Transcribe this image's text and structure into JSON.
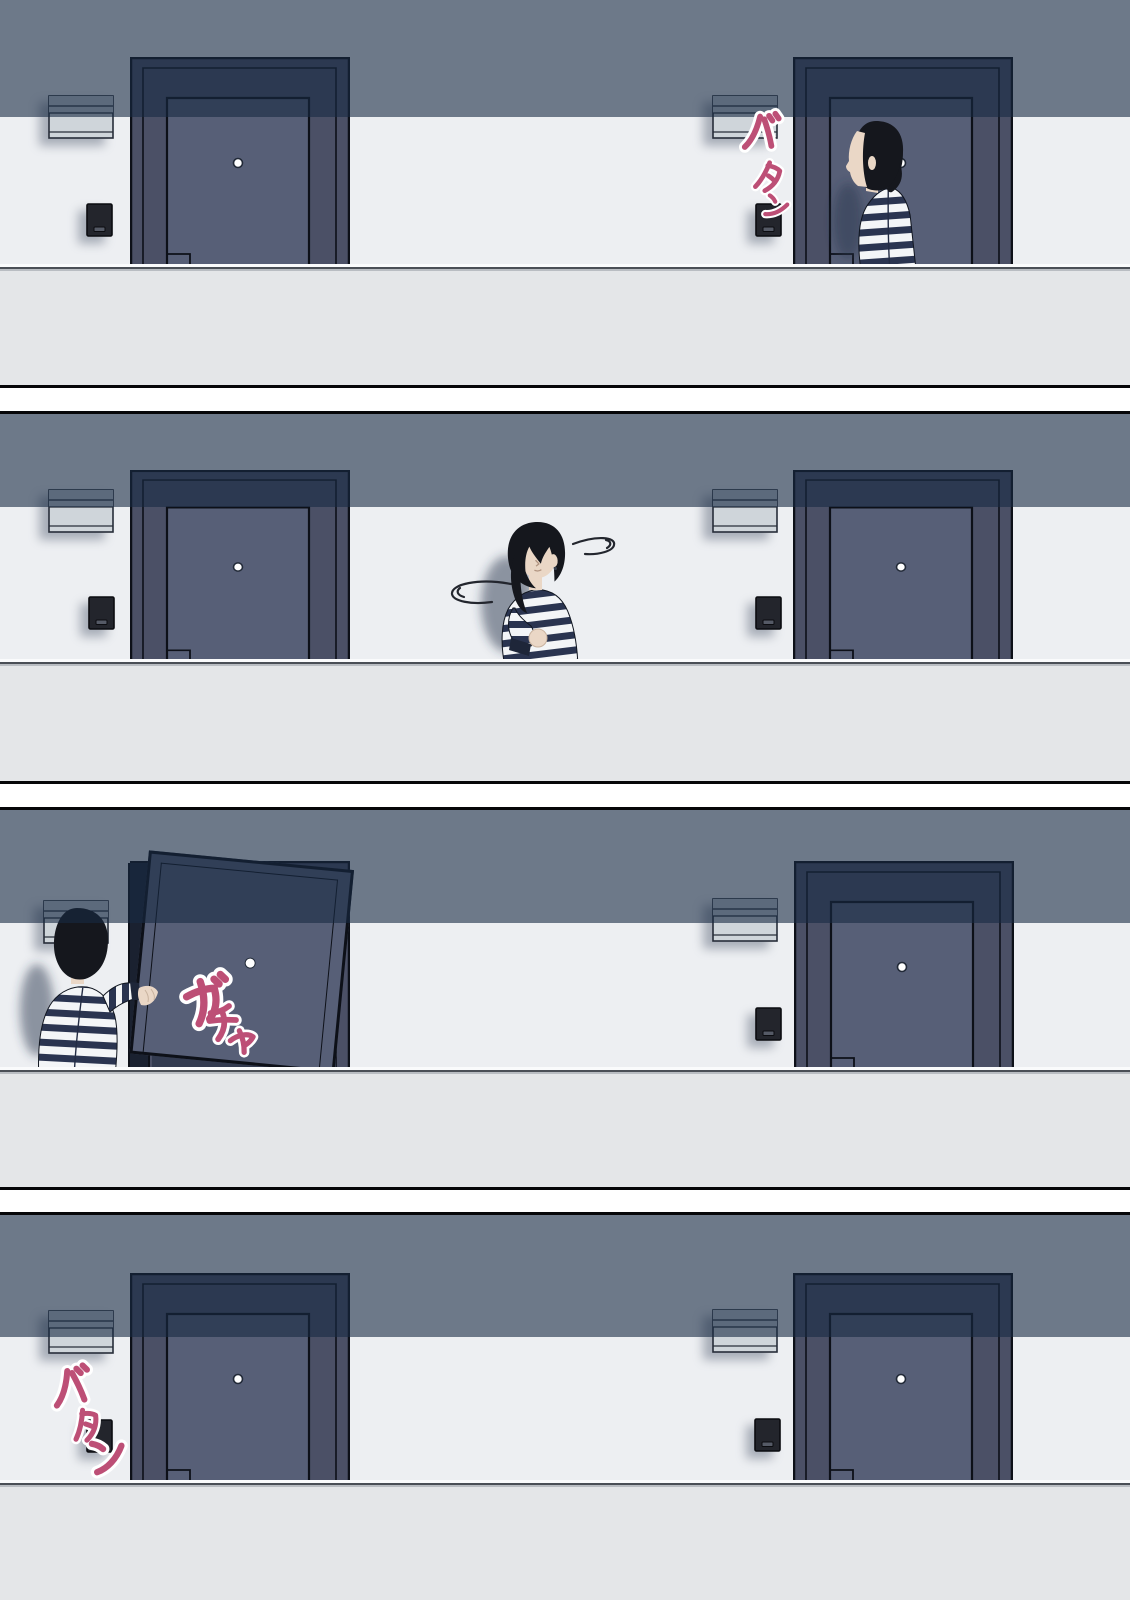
{
  "comic": {
    "type": "4-panel vertical comic strip of an apartment corridor with two front doors",
    "panel_count": 4,
    "panels": [
      {
        "label": "panel-1",
        "scene": "A woman with a black bob and navy striped shirt stands facing the right-hand apartment door that has just shut",
        "sfx": [
          {
            "text": "バタン",
            "romaji": "BATAN",
            "meaning": "slam"
          }
        ]
      },
      {
        "label": "panel-2",
        "scene": "The woman walks along the corridor between the two doors glancing around, motion swirls circling her head",
        "sfx": []
      },
      {
        "label": "panel-3",
        "scene": "The woman pulls open the left-hand apartment door",
        "sfx": [
          {
            "text": "ガチャ",
            "romaji": "GACHA",
            "meaning": "door latch click"
          }
        ]
      },
      {
        "label": "panel-4",
        "scene": "The corridor is empty, the left door has closed again",
        "sfx": [
          {
            "text": "バタン",
            "romaji": "BATAN",
            "meaning": "slam"
          }
        ]
      }
    ]
  },
  "objects": {
    "left_door": "apartment front door with peephole",
    "right_door": "apartment front door with peephole",
    "meter_box": "louvered meter/vent box on the wall beside each door",
    "intercom": "black doorbell intercom beside each door",
    "parapet": "corridor parapet ledge across the bottom of each panel"
  },
  "colors": {
    "wall": "#edeff2",
    "shadow_band": "#6c7888",
    "door_frame": "#4b5066",
    "door_panel": "#575f77",
    "floor": "#e4e6e8",
    "outline": "#0d1018",
    "hair": "#15171d",
    "skin": "#ead7c6",
    "shirt_stripe": "#2a3450",
    "shirt_base": "#f3f5f7",
    "sfx_fill": "#bd4f76",
    "sfx_halo": "#ffffff",
    "gutter": "#ffffff"
  }
}
